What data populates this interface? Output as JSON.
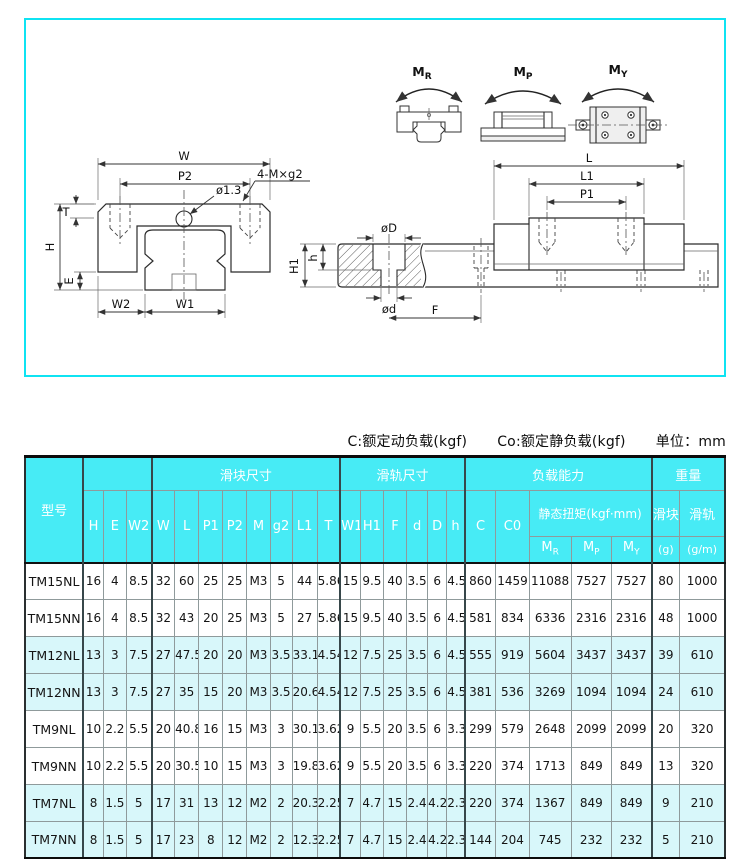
{
  "colors": {
    "frame_border": "#0fe3f2",
    "header_bg": "#47ebf5",
    "header_text": "#ffffff",
    "row_alt_bg": "#d8f7fa",
    "table_text": "#141414"
  },
  "notes": {
    "dynamic_load": "C:额定动负载(kgf)",
    "static_load": "Co:额定静负载(kgf)",
    "unit": "单位：mm"
  },
  "diagram": {
    "moments": [
      {
        "base": "M",
        "sub": "R"
      },
      {
        "base": "M",
        "sub": "P"
      },
      {
        "base": "M",
        "sub": "Y"
      }
    ],
    "front_labels": {
      "w": "W",
      "p2": "P2",
      "hole": "ø1.3",
      "screw": "4-M×g2",
      "t": "T",
      "h": "H",
      "e": "E",
      "w2": "W2",
      "w1": "W1"
    },
    "side_labels": {
      "l": "L",
      "l1": "L1",
      "p1": "P1",
      "d_big": "øD",
      "h_small": "h",
      "h1": "H1",
      "d_small": "ød",
      "f": "F"
    }
  },
  "table": {
    "groups": {
      "model": "型号",
      "slider": "滑块尺寸",
      "rail": "滑轨尺寸",
      "load": "负载能力",
      "weight": "重量"
    },
    "torque_header": "静态扭矩(kgf·mm)",
    "weight_sub": {
      "block": "滑块",
      "rail": "滑轨",
      "block_unit": "(g)",
      "rail_unit": "(g/m)"
    },
    "columns": [
      "H",
      "E",
      "W2",
      "W",
      "L",
      "P1",
      "P2",
      "M",
      "g2",
      "L1",
      "T",
      "W1",
      "H1",
      "F",
      "d",
      "D",
      "h",
      "C",
      "C0"
    ],
    "torque_cols": [
      {
        "base": "M",
        "sub": "R"
      },
      {
        "base": "M",
        "sub": "P"
      },
      {
        "base": "M",
        "sub": "Y"
      }
    ],
    "rows": [
      {
        "model": "TM15NL",
        "values": [
          "16",
          "4",
          "8.5",
          "32",
          "60",
          "25",
          "25",
          "M3",
          "5",
          "44",
          "5.86",
          "15",
          "9.5",
          "40",
          "3.5",
          "6",
          "4.5",
          "860",
          "1459",
          "11088",
          "7527",
          "7527",
          "80",
          "1000"
        ]
      },
      {
        "model": "TM15NN",
        "values": [
          "16",
          "4",
          "8.5",
          "32",
          "43",
          "20",
          "25",
          "M3",
          "5",
          "27",
          "5.86",
          "15",
          "9.5",
          "40",
          "3.5",
          "6",
          "4.5",
          "581",
          "834",
          "6336",
          "2316",
          "2316",
          "48",
          "1000"
        ]
      },
      {
        "model": "TM12NL",
        "values": [
          "13",
          "3",
          "7.5",
          "27",
          "47.5",
          "20",
          "20",
          "M3",
          "3.5",
          "33.1",
          "4.54",
          "12",
          "7.5",
          "25",
          "3.5",
          "6",
          "4.5",
          "555",
          "919",
          "5604",
          "3437",
          "3437",
          "39",
          "610"
        ]
      },
      {
        "model": "TM12NN",
        "values": [
          "13",
          "3",
          "7.5",
          "27",
          "35",
          "15",
          "20",
          "M3",
          "3.5",
          "20.6",
          "4.54",
          "12",
          "7.5",
          "25",
          "3.5",
          "6",
          "4.5",
          "381",
          "536",
          "3269",
          "1094",
          "1094",
          "24",
          "610"
        ]
      },
      {
        "model": "TM9NL",
        "values": [
          "10",
          "2.2",
          "5.5",
          "20",
          "40.8",
          "16",
          "15",
          "M3",
          "3",
          "30.1",
          "3.62",
          "9",
          "5.5",
          "20",
          "3.5",
          "6",
          "3.3",
          "299",
          "579",
          "2648",
          "2099",
          "2099",
          "20",
          "320"
        ]
      },
      {
        "model": "TM9NN",
        "values": [
          "10",
          "2.2",
          "5.5",
          "20",
          "30.5",
          "10",
          "15",
          "M3",
          "3",
          "19.8",
          "3.62",
          "9",
          "5.5",
          "20",
          "3.5",
          "6",
          "3.3",
          "220",
          "374",
          "1713",
          "849",
          "849",
          "13",
          "320"
        ]
      },
      {
        "model": "TM7NL",
        "values": [
          "8",
          "1.5",
          "5",
          "17",
          "31",
          "13",
          "12",
          "M2",
          "2",
          "20.3",
          "2.25",
          "7",
          "4.7",
          "15",
          "2.4",
          "4.2",
          "2.3",
          "220",
          "374",
          "1367",
          "849",
          "849",
          "9",
          "210"
        ]
      },
      {
        "model": "TM7NN",
        "values": [
          "8",
          "1.5",
          "5",
          "17",
          "23",
          "8",
          "12",
          "M2",
          "2",
          "12.3",
          "2.25",
          "7",
          "4.7",
          "15",
          "2.4",
          "4.2",
          "2.3",
          "144",
          "204",
          "745",
          "232",
          "232",
          "5",
          "210"
        ]
      }
    ]
  }
}
